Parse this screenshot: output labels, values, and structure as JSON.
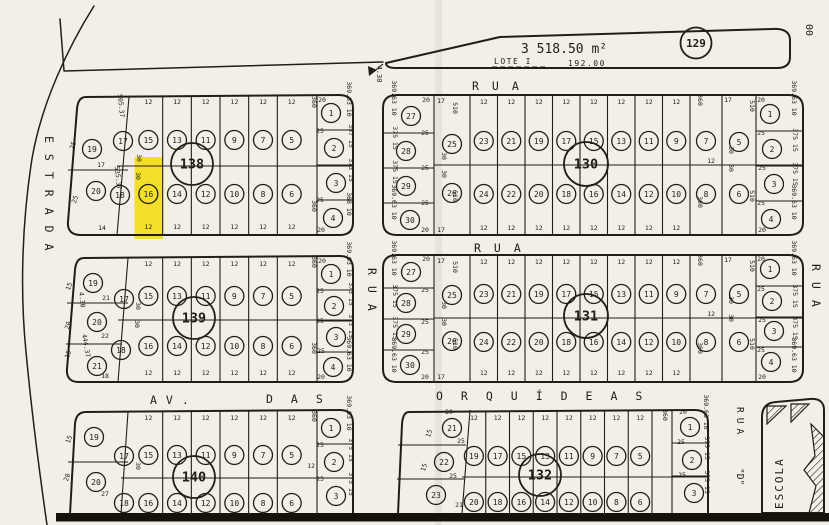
{
  "meta": {
    "paper": "#f2efe9",
    "ink": "#221d15",
    "highlight": "#f2dd0e"
  },
  "top_parcel": {
    "label": "LOTE I",
    "area": "3 518.50 m²",
    "frontage": "192.00",
    "side_dim": "4.30",
    "block_number": "129",
    "edge_mark": "00"
  },
  "streets": {
    "estrada": "ESTRADA",
    "rua_top": "RUA",
    "rua_mid": "RUA",
    "rua_central": "RUA",
    "rua_east": "RUA",
    "avenue_prefix": "AV.",
    "avenue_das": "DAS",
    "avenue_name": "ORQUÍDEAS",
    "rua_d": "RUA",
    "rua_d_suffix": "\"D\"",
    "school": "ESCOLA"
  },
  "blocks": [
    {
      "number": "138",
      "top_lots": [
        "15",
        "13",
        "11",
        "9",
        "7",
        "5"
      ],
      "bottom_lots": [
        "16",
        "14",
        "12",
        "10",
        "8",
        "6"
      ],
      "west_lots": [
        "19",
        "20"
      ],
      "inner_west_lots": [
        "17",
        "18"
      ],
      "east_lots": [
        "1",
        "2",
        "3",
        "4"
      ],
      "top_dims": [
        "12",
        "12",
        "12",
        "12",
        "12",
        "12"
      ],
      "bottom_dims": [
        "12",
        "12",
        "12",
        "12",
        "12",
        "12"
      ],
      "dims": [
        "25",
        "17",
        "25",
        "14",
        "505.37",
        "535.37",
        "30",
        "30",
        "360",
        "360",
        "20",
        "25",
        "25",
        "20",
        "369.63 10",
        "357 15",
        "373 15",
        "368 10"
      ],
      "highlighted_lot": "16"
    },
    {
      "number": "130",
      "top_lots": [
        "23",
        "21",
        "19",
        "17",
        "15",
        "13",
        "11",
        "9"
      ],
      "bottom_lots": [
        "24",
        "22",
        "20",
        "18",
        "16",
        "14",
        "12",
        "10"
      ],
      "west_lots": [
        "27",
        "28",
        "29",
        "30"
      ],
      "inner_west_lots": [
        "25",
        "26"
      ],
      "inner_east_lots": [
        "7",
        "8",
        "5",
        "6"
      ],
      "east_lots": [
        "1",
        "2",
        "3",
        "4"
      ],
      "top_dims": [
        "12",
        "12",
        "12",
        "12",
        "12",
        "12",
        "12",
        "12"
      ],
      "bottom_dims": [
        "12",
        "12",
        "12",
        "12",
        "12",
        "12",
        "12",
        "12"
      ],
      "dims": [
        "369.63 10",
        "375 15",
        "375 15",
        "369.63 10",
        "20",
        "25",
        "25",
        "25",
        "20",
        "17",
        "510",
        "30",
        "30",
        "510",
        "17",
        "360",
        "360",
        "12",
        "17",
        "510",
        "510",
        "30",
        "30",
        "20",
        "25",
        "25",
        "25",
        "20",
        "369.63 10",
        "375 15",
        "375 15",
        "369.63 10"
      ]
    },
    {
      "number": "139",
      "top_lots": [
        "15",
        "13",
        "11",
        "9",
        "7",
        "5"
      ],
      "bottom_lots": [
        "16",
        "14",
        "12",
        "10",
        "8",
        "6"
      ],
      "west_lots": [
        "19",
        "20",
        "21"
      ],
      "inner_west_lots": [
        "17",
        "18"
      ],
      "east_lots": [
        "1",
        "2",
        "3",
        "4"
      ],
      "top_dims": [
        "12",
        "12",
        "12",
        "12",
        "12",
        "12"
      ],
      "bottom_dims": [
        "12",
        "12",
        "12",
        "12",
        "12",
        "12"
      ],
      "dims": [
        "15",
        "21",
        "4.30",
        "20",
        "22",
        "15",
        "444.37",
        "18",
        "30",
        "30",
        "360",
        "360",
        "20",
        "25",
        "25",
        "25",
        "20",
        "369.63 10",
        "373 15",
        "373 15",
        "369.63 10"
      ]
    },
    {
      "number": "131",
      "top_lots": [
        "23",
        "21",
        "19",
        "17",
        "15",
        "13",
        "11",
        "9"
      ],
      "bottom_lots": [
        "24",
        "22",
        "20",
        "18",
        "16",
        "14",
        "12",
        "10"
      ],
      "west_lots": [
        "27",
        "28",
        "29",
        "30"
      ],
      "inner_west_lots": [
        "25",
        "26"
      ],
      "inner_east_lots": [
        "7",
        "8",
        "5",
        "6"
      ],
      "east_lots": [
        "1",
        "2",
        "3",
        "4"
      ],
      "top_dims": [
        "12",
        "12",
        "12",
        "12",
        "12",
        "12",
        "12",
        "12"
      ],
      "bottom_dims": [
        "12",
        "12",
        "12",
        "12",
        "12",
        "12",
        "12",
        "12"
      ],
      "dims": [
        "369.63 10",
        "375 15",
        "375 15",
        "369.63 10",
        "20",
        "25",
        "25",
        "25",
        "20",
        "17",
        "510",
        "30",
        "30",
        "510",
        "17",
        "360",
        "360",
        "12",
        "17",
        "510",
        "510",
        "30",
        "30",
        "20",
        "25",
        "25",
        "25",
        "20",
        "369.63 10",
        "375 15",
        "375 15",
        "369.63 10"
      ]
    },
    {
      "number": "140",
      "top_lots": [
        "15",
        "13",
        "11",
        "9",
        "7",
        "5"
      ],
      "bottom_lots": [
        "16",
        "14",
        "12",
        "10",
        "8",
        "6"
      ],
      "west_lots": [
        "19",
        "20"
      ],
      "inner_west_lots": [
        "17",
        "18"
      ],
      "east_lots": [
        "1",
        "2",
        "3"
      ],
      "top_dims": [
        "12",
        "12",
        "12",
        "12",
        "12",
        "12"
      ],
      "bottom_dims": [],
      "dims": [
        "15",
        "20",
        "27",
        "30",
        "360",
        "12",
        "25",
        "25",
        "369.63 10",
        "375 15",
        "375 15"
      ]
    },
    {
      "number": "132",
      "top_lots": [
        "19",
        "17",
        "15",
        "13",
        "11",
        "9",
        "7",
        "5"
      ],
      "bottom_lots": [
        "20",
        "18",
        "16",
        "14",
        "12",
        "10",
        "8",
        "6"
      ],
      "west_lots": [
        "21",
        "22",
        "23"
      ],
      "east_lots": [
        "1",
        "2",
        "3"
      ],
      "top_dims": [
        "12",
        "12",
        "12",
        "12",
        "12",
        "12",
        "12",
        "12"
      ],
      "bottom_dims": [],
      "dims": [
        "20",
        "15",
        "25",
        "15",
        "25",
        "21",
        "360",
        "20",
        "25",
        "25",
        "369.63 10",
        "375 15",
        "375 15"
      ]
    }
  ]
}
